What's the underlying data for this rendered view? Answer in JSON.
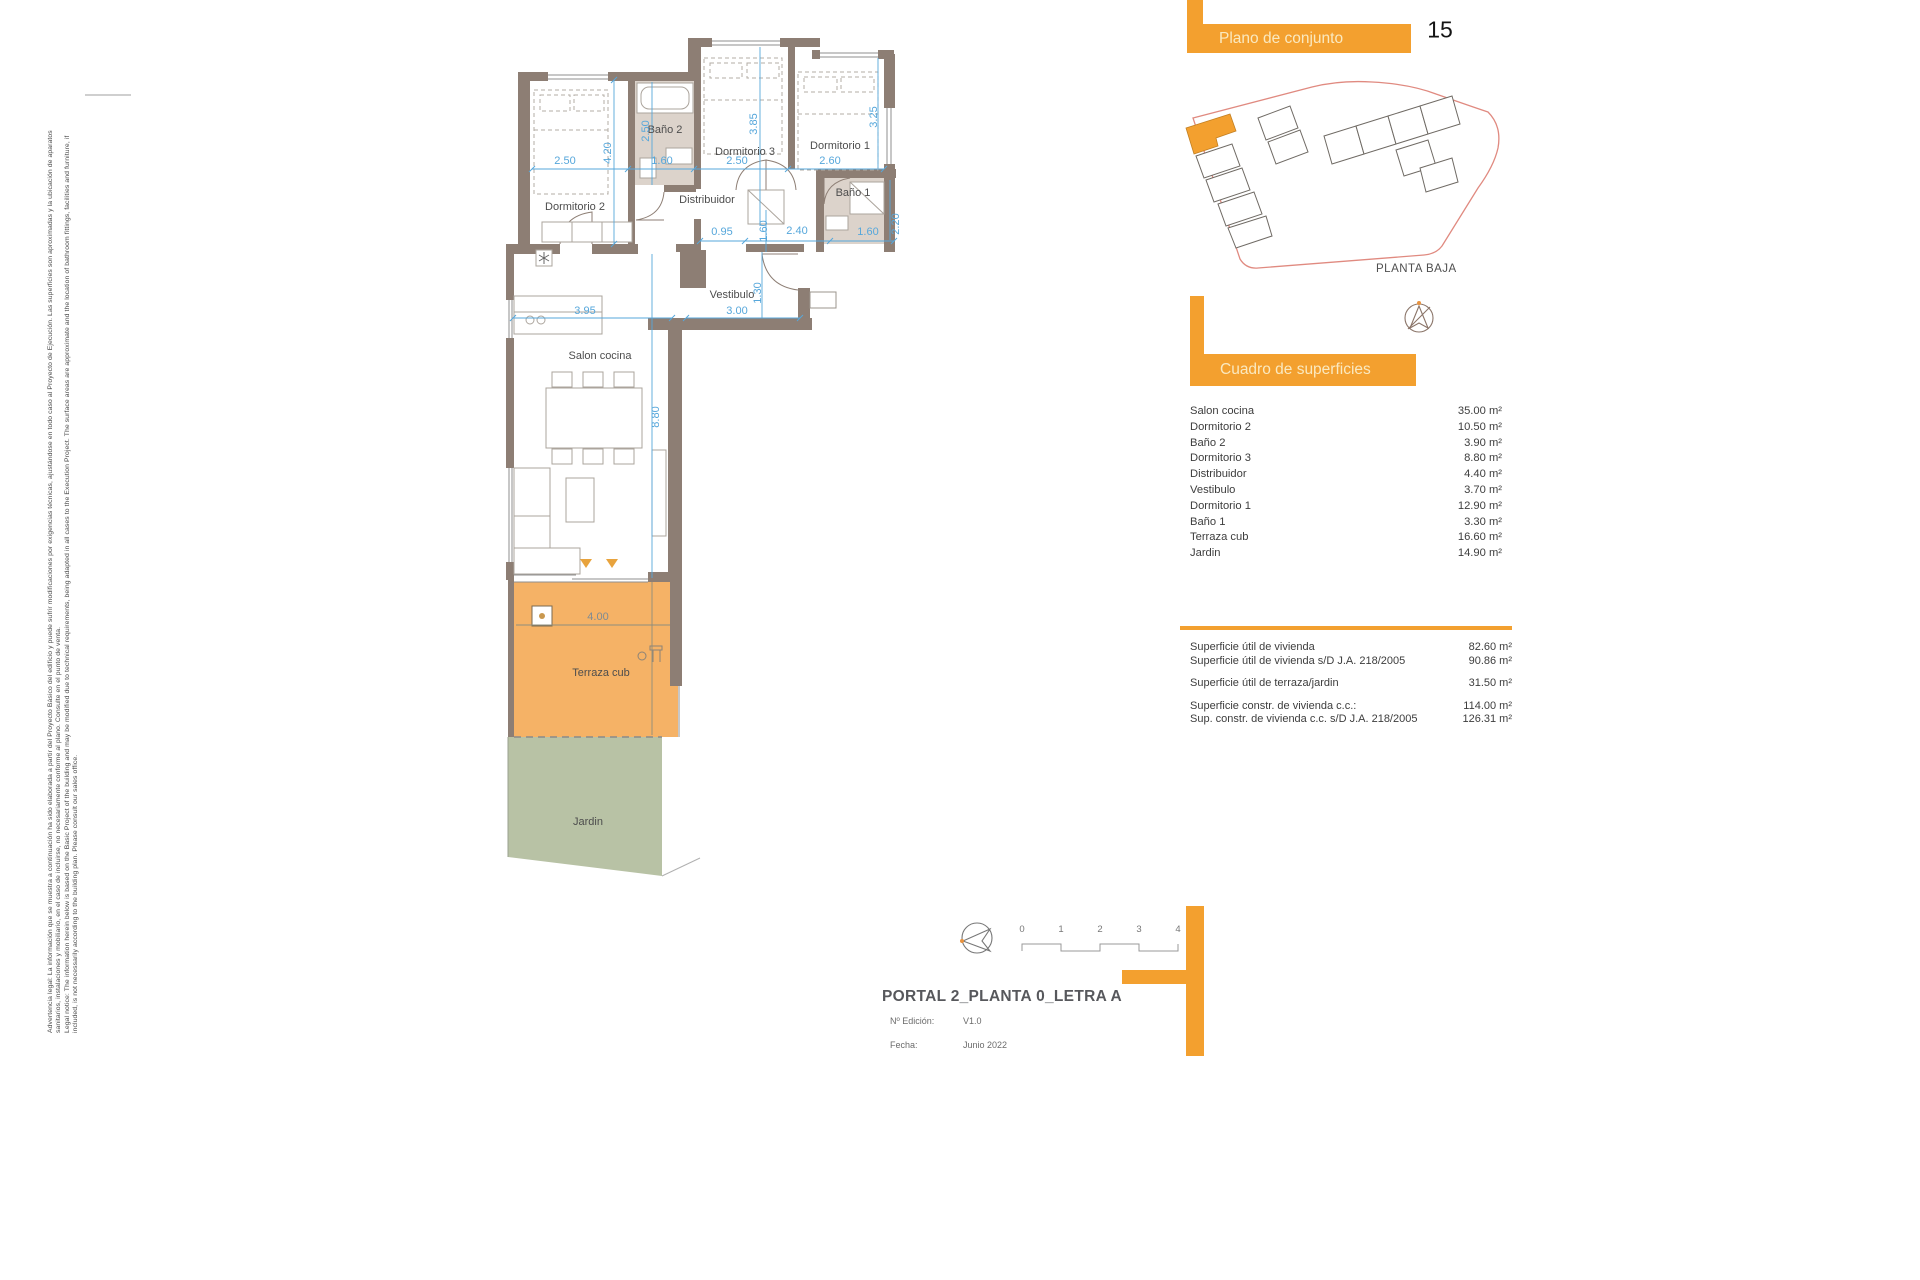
{
  "page_number": "15",
  "site_plan": {
    "title": "Plano de conjunto",
    "caption": "PLANTA BAJA"
  },
  "surfaces": {
    "title": "Cuadro de superficies",
    "rows": [
      {
        "label": "Salon cocina",
        "value": "35.00 m²"
      },
      {
        "label": "Dormitorio 2",
        "value": "10.50 m²"
      },
      {
        "label": "Baño 2",
        "value": "3.90 m²"
      },
      {
        "label": "Dormitorio 3",
        "value": "8.80 m²"
      },
      {
        "label": "Distribuidor",
        "value": "4.40 m²"
      },
      {
        "label": "Vestibulo",
        "value": "3.70 m²"
      },
      {
        "label": "Dormitorio 1",
        "value": "12.90 m²"
      },
      {
        "label": "Baño 1",
        "value": "3.30 m²"
      },
      {
        "label": "Terraza cub",
        "value": "16.60 m²"
      },
      {
        "label": "Jardin",
        "value": "14.90 m²"
      }
    ],
    "summary": [
      {
        "label": "Superficie útil de vivienda",
        "value": "82.60 m²"
      },
      {
        "label": "Superficie útil de vivienda s/D J.A. 218/2005",
        "value": "90.86 m²"
      },
      {
        "label": "Superficie útil de terraza/jardin",
        "value": "31.50 m²"
      },
      {
        "label": "Superficie constr. de vivienda c.c.:",
        "value": "114.00 m²"
      },
      {
        "label": "Sup. constr. de vivienda c.c. s/D J.A. 218/2005",
        "value": "126.31 m²"
      }
    ]
  },
  "title_block": {
    "title": "PORTAL 2_PLANTA 0_LETRA A",
    "edition_label": "Nº Edición:",
    "edition_value": "V1.0",
    "date_label": "Fecha:",
    "date_value": "Junio 2022"
  },
  "scale_bar": {
    "ticks": [
      "0",
      "1",
      "2",
      "3",
      "4"
    ]
  },
  "plan": {
    "rooms": {
      "dormitorio2": "Dormitorio 2",
      "bano2": "Baño 2",
      "dormitorio3": "Dormitorio 3",
      "dormitorio1": "Dormitorio 1",
      "bano1": "Baño 1",
      "distribuidor": "Distribuidor",
      "vestibulo": "Vestibulo",
      "salon": "Salon cocina",
      "terraza": "Terraza cub",
      "jardin": "Jardin"
    },
    "dims": {
      "dorm2_w": "2.50",
      "dorm2_h": "4.20",
      "bano2_h": "2.50",
      "bano2_w": "1.60",
      "dorm3_h": "3.85",
      "dorm3_w": "2.50",
      "dorm1_h": "3.25",
      "dorm1_w": "2.60",
      "distrib_1": "0.95",
      "distrib_2": "1.60",
      "distrib_3": "2.40",
      "bano1_h": "2.20",
      "bano1_w": "1.60",
      "vest_h": "1.30",
      "vest_w": "3.00",
      "salon_w": "3.95",
      "salon_h": "8.80",
      "terraza_w": "4.00"
    }
  },
  "legal": {
    "es_1": "Advertencia legal: La información que se muestra a continuación ha sido elaborada a partir del Proyecto Básico del edificio y puede sufrir modificaciones por exigencias técnicas, ajustándose en todo caso al Proyecto de Ejecución. Las superficies son aproximadas y la ubicación de aparatos",
    "es_2": "sanitarios, instalaciones y mobiliario, en el caso de incluirse, no necesariamente conforme al plano. Consulte en el punto de venta.",
    "en_1": "Legal notice: The information herein below is based on the Basic Project of the building and may be modified due to technical requirements, being adapted in all cases to the Execution Project. The surface areas are approximate and the location of bathroom fittings, facilities and furniture, if",
    "en_2": "included, is not necessarily according to the building plan. Please consult our sales office."
  },
  "colors": {
    "accent": "#F3A02F",
    "terrace": "#F5B266",
    "garden": "#B8C2A5",
    "wall": "#8D7E74",
    "dim": "#56A7DB",
    "siteline": "#E08A80"
  }
}
